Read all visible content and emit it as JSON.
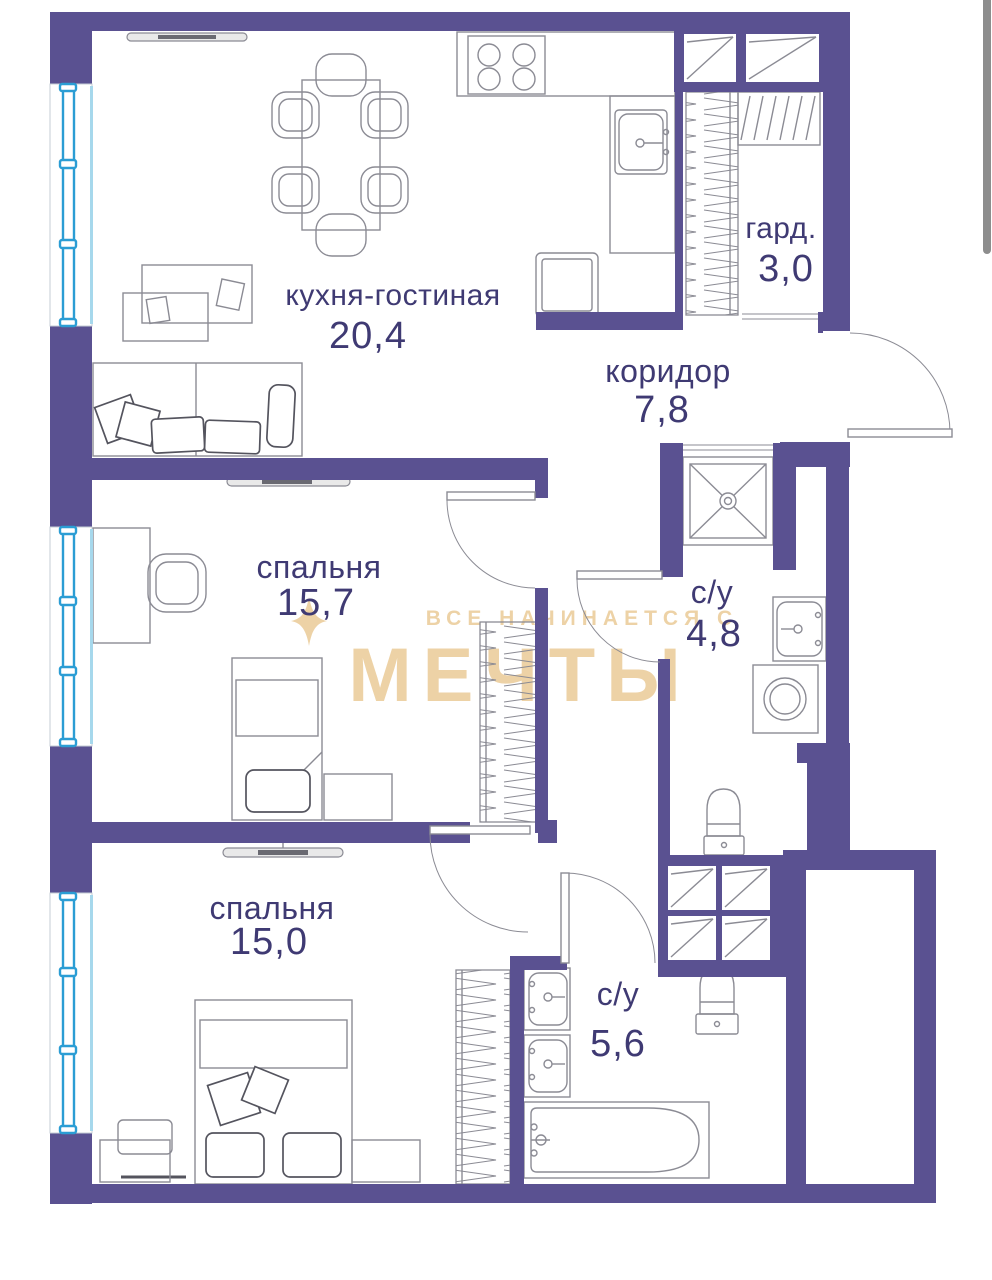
{
  "rooms": [
    {
      "id": "kitchen-living",
      "name": "кухня-гостиная",
      "area": "20,4"
    },
    {
      "id": "wardrobe-room",
      "name": "гард.",
      "area": "3,0"
    },
    {
      "id": "corridor",
      "name": "коридор",
      "area": "7,8"
    },
    {
      "id": "bedroom-1",
      "name": "спальня",
      "area": "15,7"
    },
    {
      "id": "bathroom-1",
      "name": "с/у",
      "area": "4,8"
    },
    {
      "id": "bedroom-2",
      "name": "спальня",
      "area": "15,0"
    },
    {
      "id": "bathroom-2",
      "name": "с/у",
      "area": "5,6"
    }
  ],
  "watermark": {
    "line1": "ВСЕ НАЧИНАЕТСЯ С",
    "line2": "МЕЧТЫ"
  },
  "colors": {
    "wall": "#5a5191",
    "label": "#3f3a73",
    "furniture": "#8b8b94",
    "p-dark": "#54545e",
    "window": "#2b9dd4",
    "window_light": "#a6d8ec",
    "watermark": "#edd2a6",
    "scrollbar": "#8d8d8d"
  }
}
